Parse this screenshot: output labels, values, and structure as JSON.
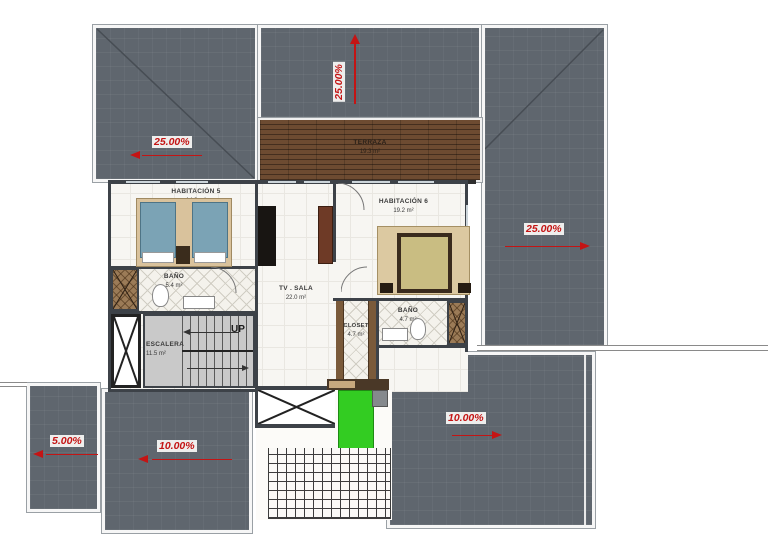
{
  "drawing": {
    "type": "floor-plan",
    "rooms": {
      "habitacion5": {
        "name": "HABITACIÓN 5",
        "area": "14.3 m²"
      },
      "habitacion6": {
        "name": "HABITACIÓN 6",
        "area": "19.2 m²"
      },
      "bano5": {
        "name": "BAÑO",
        "area": "5.4 m²"
      },
      "bano6": {
        "name": "BAÑO",
        "area": "4.7 m²"
      },
      "tv_sala": {
        "name": "TV . SALA",
        "area": "22.0 m²"
      },
      "escalera": {
        "name": "ESCALERA",
        "area": "11.5 m²"
      },
      "closet": {
        "name": "CLOSET",
        "area": "4.7 m²"
      },
      "terraza": {
        "name": "TERRAZA",
        "area": "19.3 m²"
      }
    },
    "stairs": {
      "direction_label": "UP"
    },
    "roof_slopes": {
      "top": "25.00%",
      "left": "25.00%",
      "right": "25.00%",
      "bottom_left": "5.00%",
      "bottom_middle": "10.00%",
      "bottom_right": "10.00%"
    },
    "colors": {
      "roof": "#5f666e",
      "slope_red": "#c41414",
      "terrace_wood": "#6d4b31",
      "lawn_green": "#33cc22",
      "wall": "#3d4248"
    }
  }
}
